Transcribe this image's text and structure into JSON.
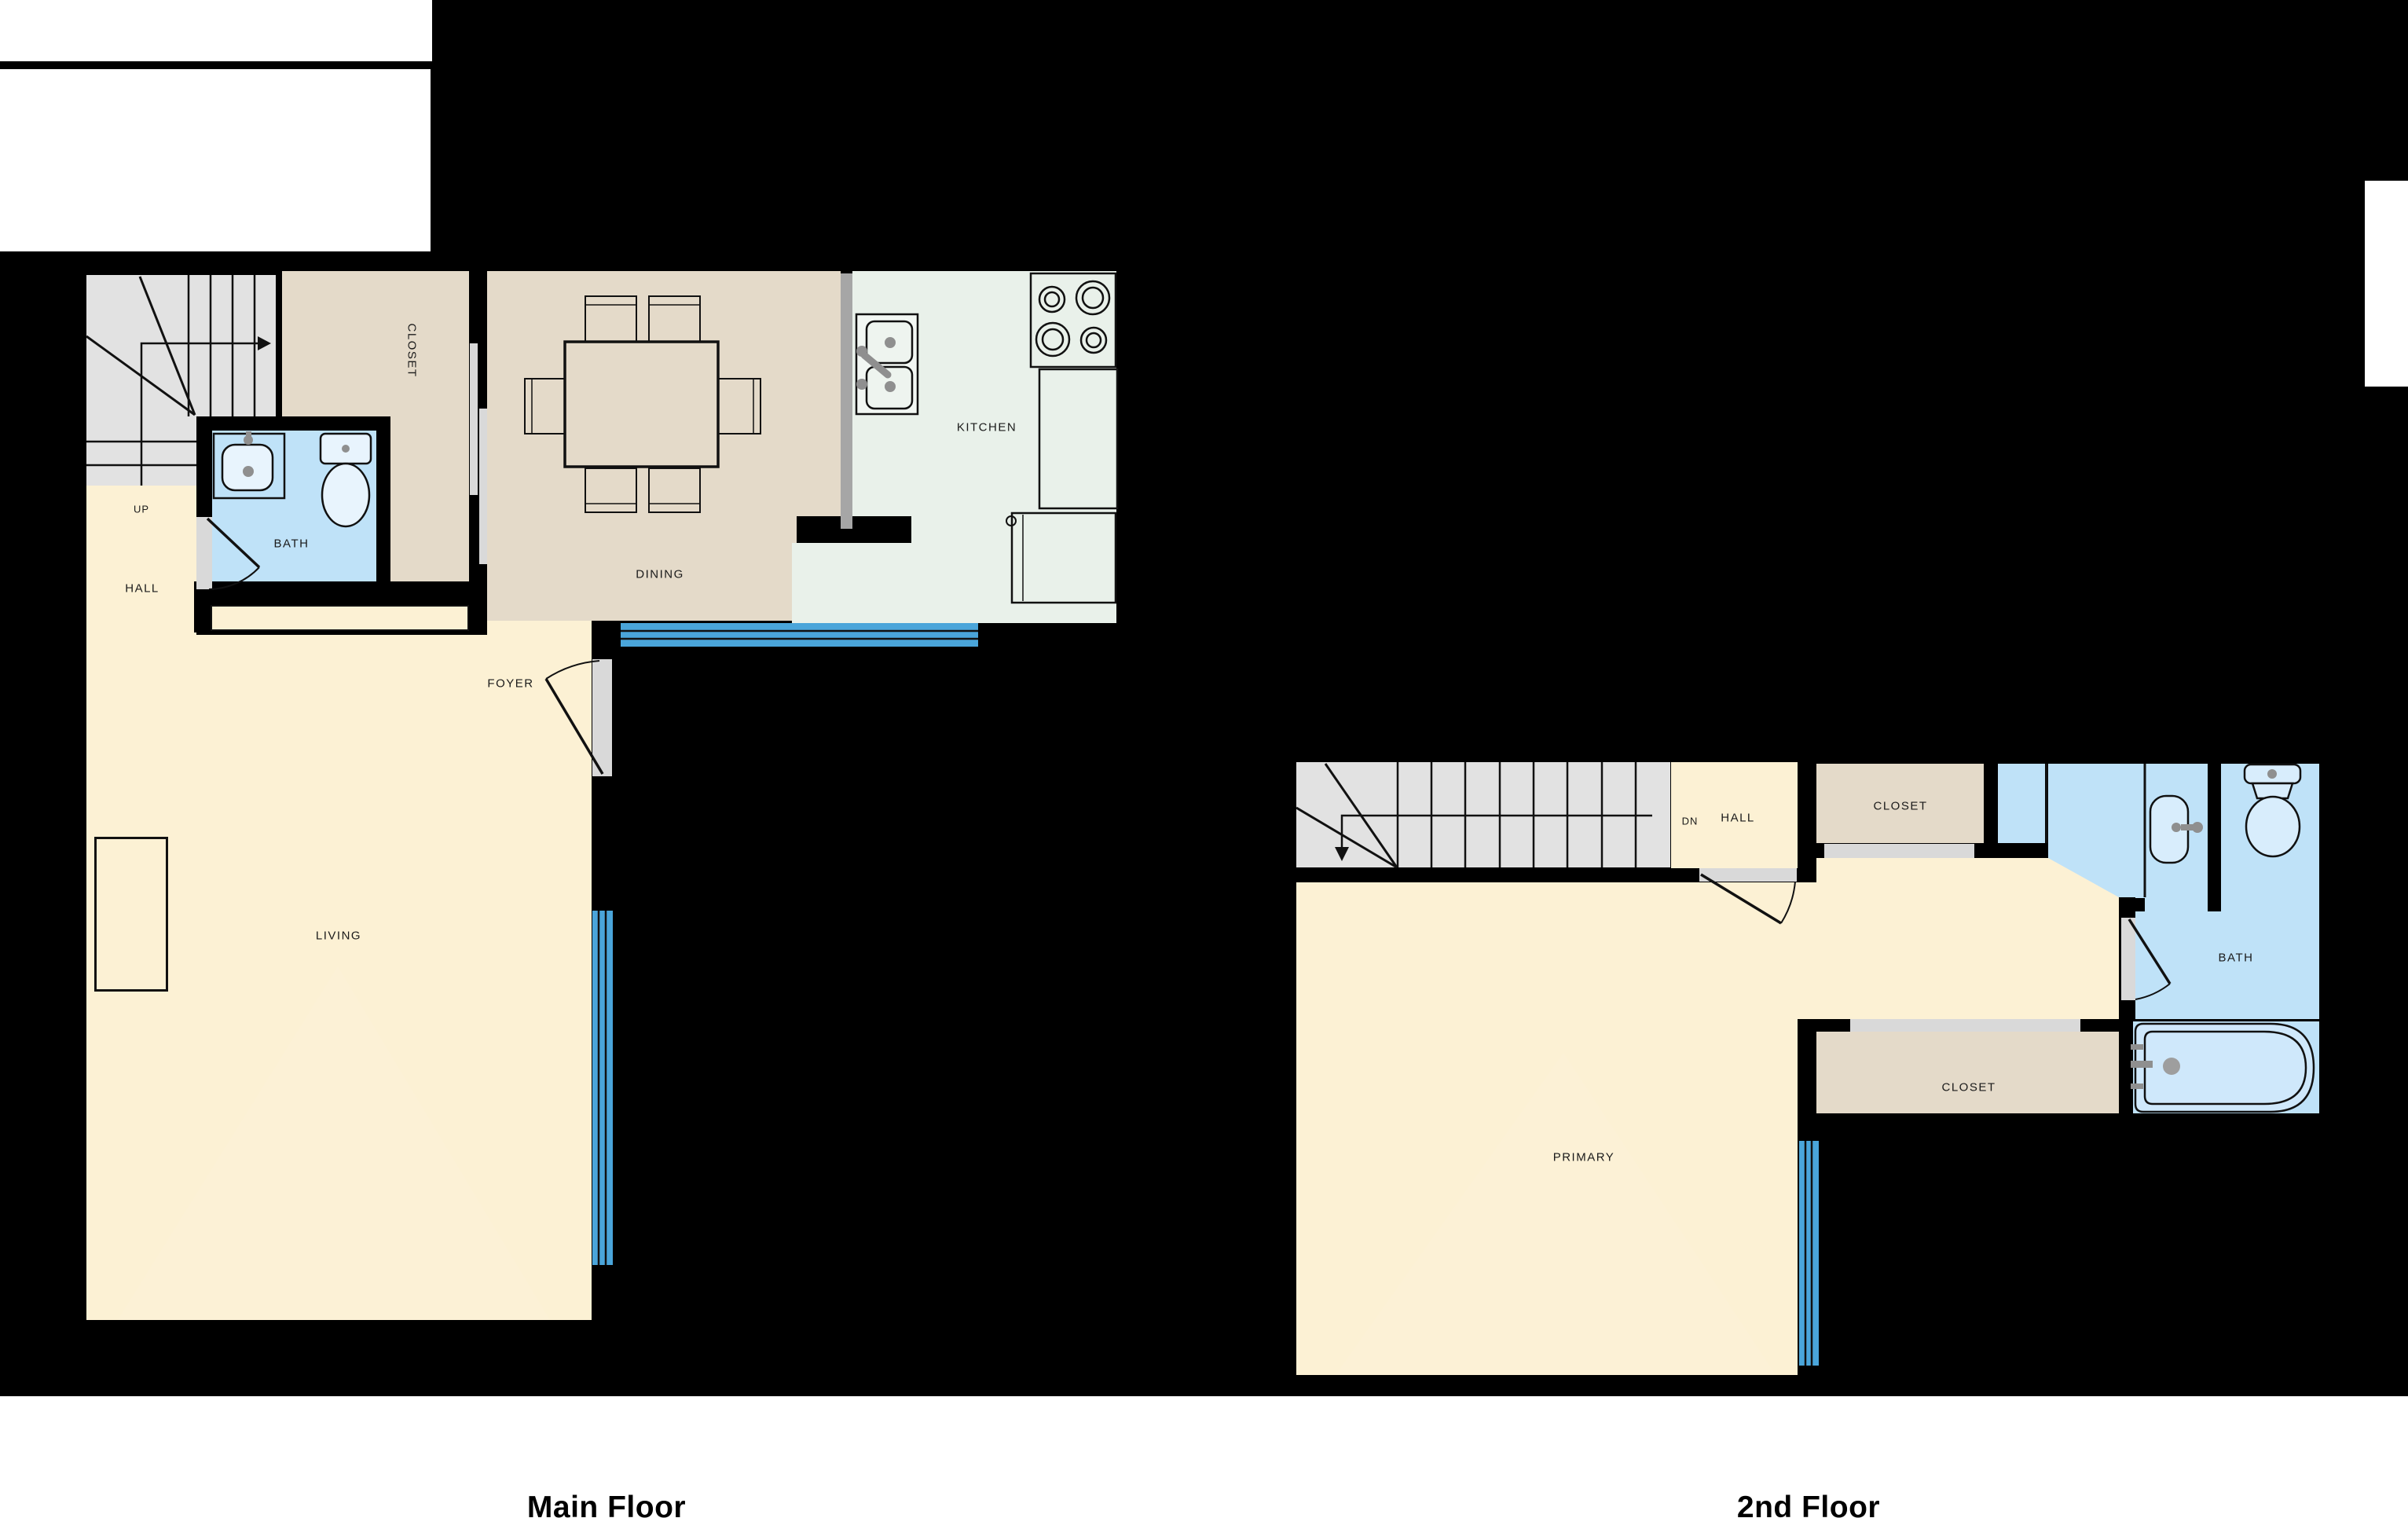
{
  "palette": {
    "background": "#000000",
    "paper_white": "#ffffff",
    "floor_cream": "#fcf1d4",
    "closet_tan": "#e4dac9",
    "bath_blue": "#bfe2f8",
    "kitchen_mint": "#e9f1ea",
    "stair_gray": "#e2e2e2",
    "sill_gray": "#d9d9d9",
    "window_blue": "#4aa5da",
    "counter_gray": "#a6a6a6",
    "fixture_gray": "#8f8f8f",
    "line": "#111111",
    "label_text": "#1a1a1a",
    "caption_text": "#000000"
  },
  "captions": {
    "main": "Main Floor",
    "second": "2nd Floor"
  },
  "main_floor": {
    "rooms": {
      "stairs_up": "UP",
      "hall": "HALL",
      "bath": "BATH",
      "closet": "CLOSET",
      "dining": "DINING",
      "kitchen": "KITCHEN",
      "foyer": "FOYER",
      "living": "LIVING"
    }
  },
  "second_floor": {
    "rooms": {
      "stairs_dn": "DN",
      "hall": "HALL",
      "closet_top": "CLOSET",
      "bath": "BATH",
      "closet_bottom": "CLOSET",
      "primary": "PRIMARY"
    }
  }
}
